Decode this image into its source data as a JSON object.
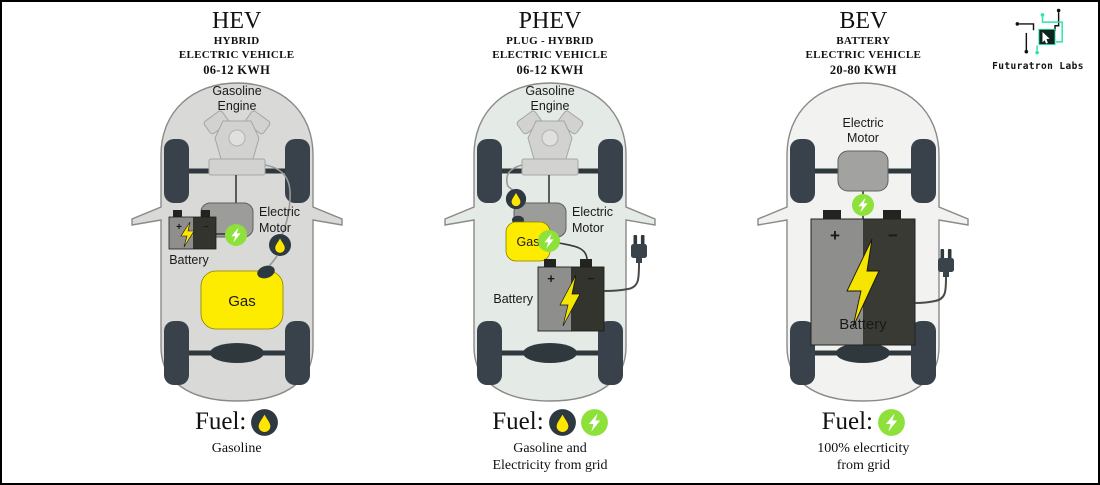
{
  "brand": {
    "name": "Futuratron Labs",
    "accent": "#2be3a4"
  },
  "colors": {
    "hev_body": "#d9d9d7",
    "phev_body": "#e4eae5",
    "bev_body": "#f2f2f0",
    "accent_green": "#8ee03a",
    "gas_yellow": "#fdeb00",
    "dark_slate": "#39424a",
    "bolt_yellow": "#f5e500"
  },
  "panels": [
    {
      "id": "hev",
      "title": "HEV",
      "subtitle1": "HYBRID",
      "subtitle2": "ELECTRIC VEHICLE",
      "capacity": "06-12 KWH",
      "labels": {
        "engine1": "Gasoline",
        "engine2": "Engine",
        "motor1": "Electric",
        "motor2": "Motor",
        "battery": "Battery",
        "gas": "Gas",
        "plus": "+",
        "minus": "−"
      },
      "fuel_label": "Fuel:",
      "fuel_sources": [
        "gasoline"
      ],
      "caption1": "Gasoline",
      "caption2": ""
    },
    {
      "id": "phev",
      "title": "PHEV",
      "subtitle1": "PLUG - HYBRID",
      "subtitle2": "ELECTRIC VEHICLE",
      "capacity": "06-12 KWH",
      "labels": {
        "engine1": "Gasoline",
        "engine2": "Engine",
        "motor1": "Electric",
        "motor2": "Motor",
        "battery": "Battery",
        "gas": "Gas",
        "plus": "+",
        "minus": "−"
      },
      "fuel_label": "Fuel:",
      "fuel_sources": [
        "gasoline",
        "electricity"
      ],
      "caption1": "Gasoline and",
      "caption2": "Electricity from grid"
    },
    {
      "id": "bev",
      "title": "BEV",
      "subtitle1": "BATTERY",
      "subtitle2": "ELECTRIC VEHICLE",
      "capacity": "20-80 KWH",
      "labels": {
        "motor1": "Electric",
        "motor2": "Motor",
        "battery": "Battery",
        "plus": "+",
        "minus": "−"
      },
      "fuel_label": "Fuel:",
      "fuel_sources": [
        "electricity"
      ],
      "caption1": "100% elecrticity",
      "caption2": "from grid"
    }
  ]
}
